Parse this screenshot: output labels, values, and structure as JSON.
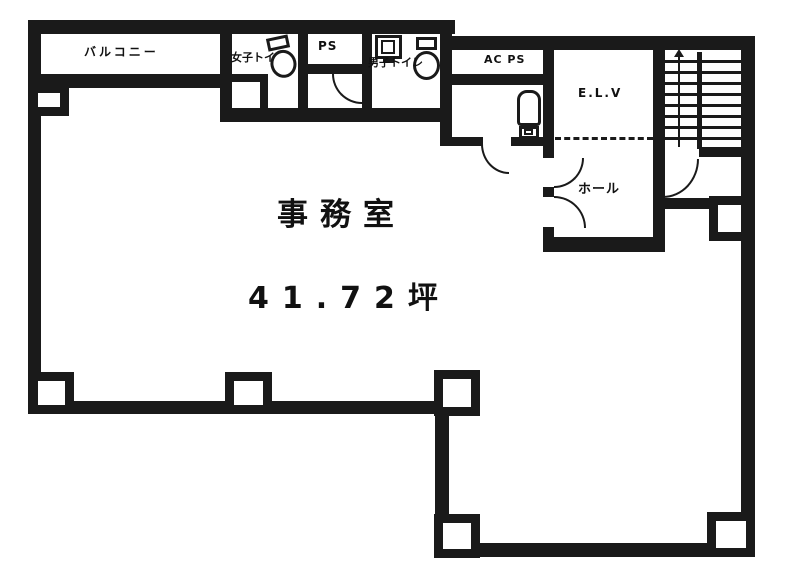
{
  "meta": {
    "type": "floor-plan"
  },
  "colors": {
    "wall": "#1a1a1a",
    "background": "#ffffff"
  },
  "rooms": {
    "balcony": {
      "label": "バルコニー"
    },
    "womens_toilet": {
      "label": "女子トイレ"
    },
    "pipe_space": {
      "label": "PS"
    },
    "mens_toilet": {
      "label": "男子トイレ"
    },
    "ac_pipe_space": {
      "label": "AC PS"
    },
    "elevator": {
      "label": "E.L.V"
    },
    "hall": {
      "label": "ホール"
    },
    "office": {
      "label": "事務室",
      "area": "41.72坪"
    }
  }
}
